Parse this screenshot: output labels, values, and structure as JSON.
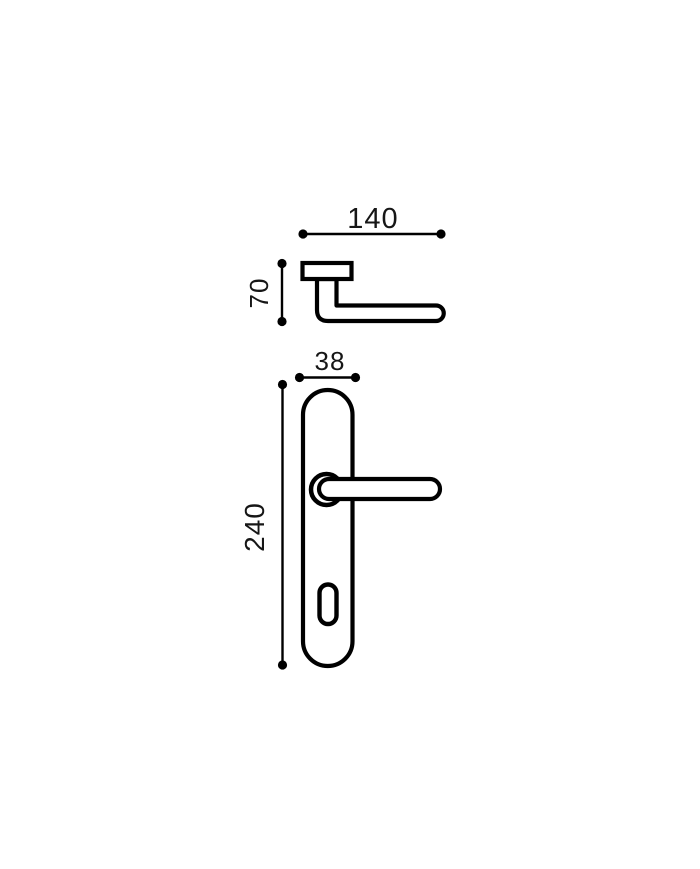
{
  "drawing": {
    "title": "door-handle-technical-drawing",
    "background_color": "#ffffff",
    "stroke_color": "#000000",
    "views": {
      "side_view": {
        "name": "handle side view",
        "parts": [
          "rose-mount",
          "handle-neck",
          "lever-arm"
        ]
      },
      "front_view": {
        "name": "handle on backplate front view",
        "parts": [
          "backplate",
          "rose-circle",
          "lever",
          "keyhole"
        ]
      }
    },
    "dimensions": {
      "handle_length": "140",
      "handle_height": "70",
      "plate_width": "38",
      "plate_height": "240"
    }
  }
}
